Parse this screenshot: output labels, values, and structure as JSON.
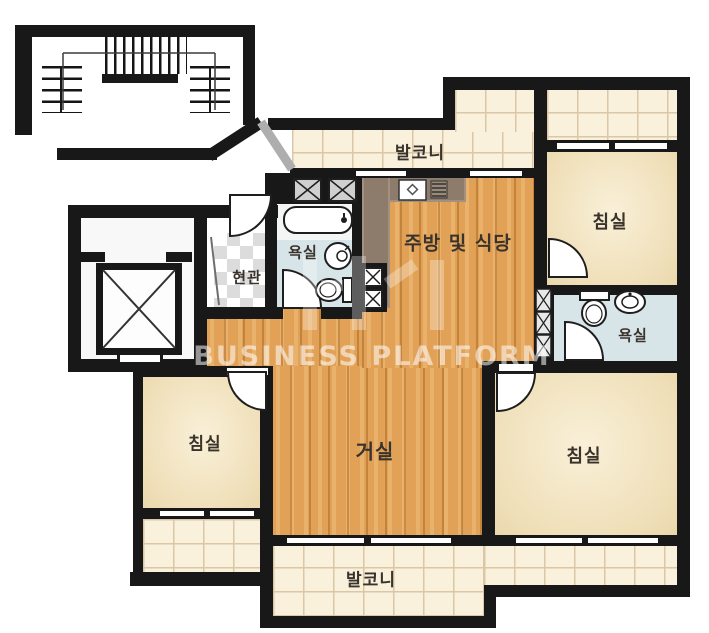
{
  "palette": {
    "wall": "#181818",
    "wood_floor": "#e1a157",
    "bedroom_floor": "#f0e0ba",
    "balcony_tile": "#faf1dd",
    "bathroom_floor": "#d7e4e8",
    "kitchen_counter": "#8d7b6b",
    "entrance_tile": "#dcdcdc",
    "label_text": "#3a332b"
  },
  "rooms": {
    "balcony_top": {
      "label": "발코니"
    },
    "bedroom_top_right": {
      "label": "침실"
    },
    "kitchen_dining": {
      "label": "주방 및 식당"
    },
    "bathroom_main": {
      "label": "욕실"
    },
    "entrance": {
      "label": "현관"
    },
    "bathroom_second": {
      "label": "욕실"
    },
    "living_room": {
      "label": "거실"
    },
    "bedroom_left": {
      "label": "침실"
    },
    "bedroom_bottom_right": {
      "label": "침실"
    },
    "balcony_bottom": {
      "label": "발코니"
    }
  },
  "watermark": {
    "text": "BUSINESS PLATFORM"
  }
}
